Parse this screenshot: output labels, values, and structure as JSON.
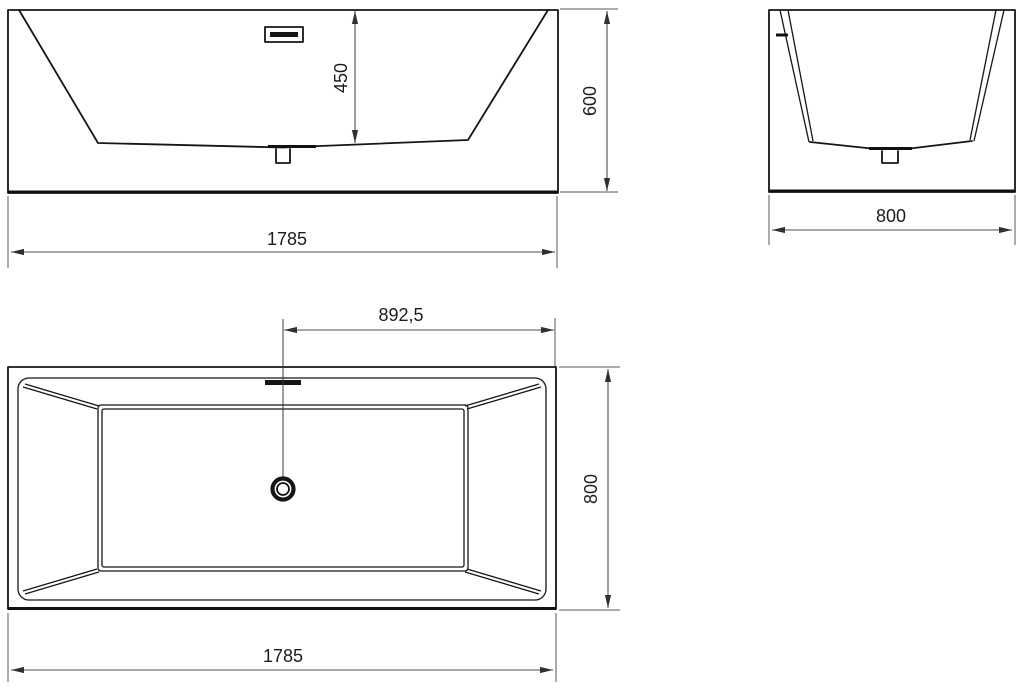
{
  "drawing": {
    "type": "bathtub-technical-drawing",
    "colors": {
      "background": "#ffffff",
      "outline": "#161616",
      "dimension_line": "#4f4f4f",
      "label_text": "#1c1c1c"
    },
    "dimensions": {
      "front_width": "1785",
      "front_height": "600",
      "front_inner_depth": "450",
      "side_width": "800",
      "top_drain_offset": "892,5",
      "top_width": "1785",
      "top_depth": "800"
    }
  }
}
